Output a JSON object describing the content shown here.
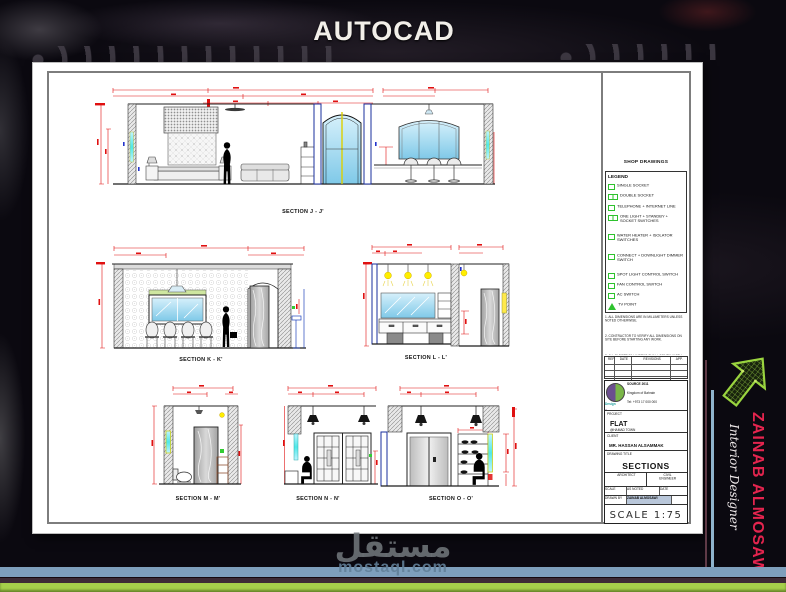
{
  "page": {
    "title": "AUTOCAD"
  },
  "watermark": {
    "arabic": "مستقل",
    "site": "mostaql.com"
  },
  "branding": {
    "name": "ZAINAB ALMOSAWI",
    "role": "Interior Designer",
    "name_color": "#e4244e",
    "arrow_color": "#8dc63f"
  },
  "sheet": {
    "sections": [
      {
        "label": "SECTION J - J'"
      },
      {
        "label": "SECTION K - K'"
      },
      {
        "label": "SECTION L - L'"
      },
      {
        "label": "SECTION M - M'"
      },
      {
        "label": "SECTION N - N'"
      },
      {
        "label": "SECTION O - O'"
      }
    ],
    "legend": {
      "header": "SHOP DRAWINGS",
      "title": "LEGEND",
      "items": [
        {
          "icon": "single-socket-icon",
          "label": "SINGLE SOCKET"
        },
        {
          "icon": "double-socket-icon",
          "label": "DOUBLE SOCKET"
        },
        {
          "icon": "telephone-internet-icon",
          "label": "TELEPHONE + INTERNET LINE"
        },
        {
          "icon": "light-switch-icon",
          "label": "ONE LIGHT + STANDBY + SOCKET SWITCHES"
        },
        {
          "icon": "heater-switch-icon",
          "label": "WATER HEATER + ISOLATOR SWITCHES"
        },
        {
          "icon": "dimmer-switch-icon",
          "label": "CONNECT + DOWNLIGHT DIMMER SWITCH"
        },
        {
          "icon": "spot-switch-icon",
          "label": "SPOT LIGHT CONTROL SWITCH"
        },
        {
          "icon": "fan-switch-icon",
          "label": "FAN CONTROL SWITCH"
        },
        {
          "icon": "ac-switch-icon",
          "label": "AC SWITCH"
        },
        {
          "icon": "tv-point-icon",
          "label": "TV POINT"
        },
        {
          "icon": "strip-light-icon",
          "label": "L.E.D. STRIP LIGHT"
        },
        {
          "icon": "wall-light-icon",
          "label": "WALL LIGHT"
        }
      ]
    },
    "notes": [
      "1. ALL DIMENSIONS ARE IN MILLIMETERS UNLESS NOTED OTHERWISE.",
      "2. CONTRACTOR TO VERIFY ALL DIMENSIONS ON SITE BEFORE STARTING ANY WORK.",
      "3. ALL ELECTRICAL WORKS SHALL COMPLY WITH LOCAL AUTHORITY REGULATIONS. ANY DISCREPANCY TO BE REPORTED TO THE DESIGNER BEFORE EXECUTION.",
      "4. WRITTEN DIMENSIONS TAKE PRECEDENCE OVER SCALED DIMENSIONS."
    ],
    "revisions": {
      "headers": [
        "REF",
        "DATE",
        "REVISIONS",
        "APP."
      ]
    },
    "title_block": {
      "company": {
        "logo_top": "Design",
        "logo_bottom": "Source",
        "name": "SOURCE 2011",
        "lines": [
          "Kingdom of Bahrain",
          "Tel: +973 17 000 000",
          "Fax: +973 17 000 000",
          "www.sourcedesign-bh.com"
        ]
      },
      "project_label": "PROJECT",
      "project": "FLAT",
      "project_sub": "@HAMAD TOWN",
      "client_label": "CLIENT",
      "client": "MR. HASSAN ALSAMMAK",
      "drawing_title_label": "DRAWING TITLE",
      "drawing_title": "SECTIONS",
      "architect_label": "ARCHITECT",
      "engineer_label": "CIVIL ENGINEER",
      "scale_label": "SCALE",
      "scale_value": "AS NOTED",
      "date_label": "DATE",
      "drawn_label": "DRAWN BY",
      "drawn_value": "ZAINAB ALMOSAWI",
      "scale_note": "SCALE 1:75"
    }
  },
  "colors": {
    "dim_red": "#e01010",
    "legend_green": "#2ec22e",
    "stripe_blue": "#7e9fbc",
    "stripe_maroon": "#3d2b35",
    "stripe_green": "#a6cf4a",
    "accent_cyan": "#4fe8e8",
    "accent_yellow": "#ffee00"
  }
}
